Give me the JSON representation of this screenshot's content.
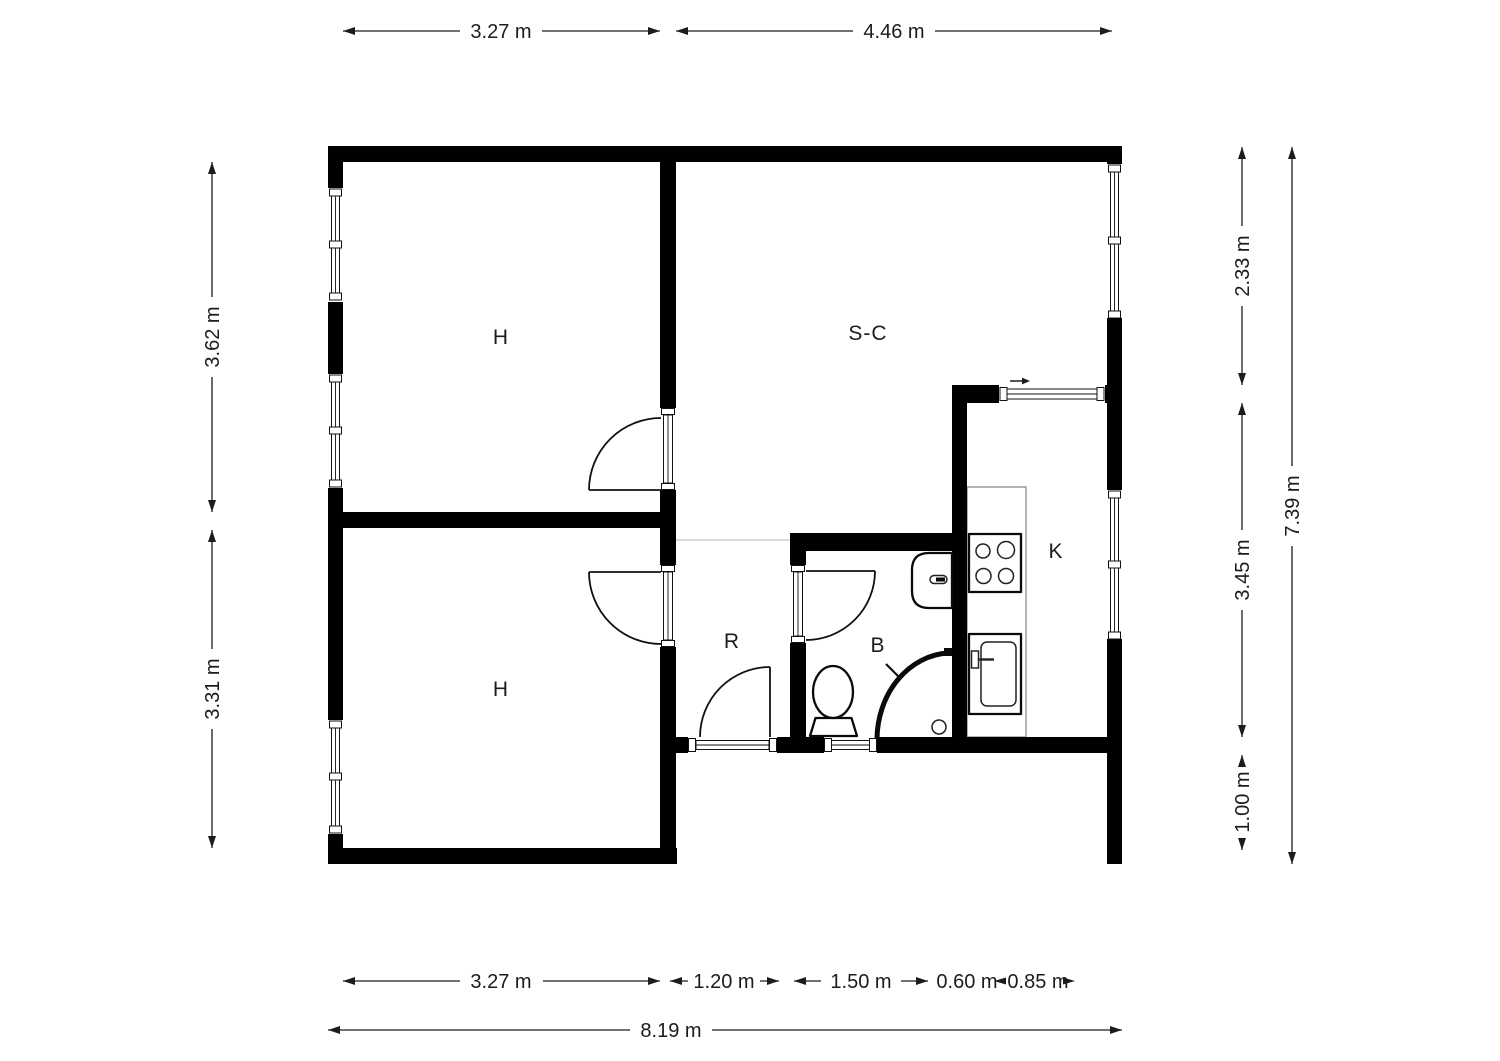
{
  "page": {
    "background_color": "#ffffff"
  },
  "floorplan": {
    "type": "apartment-floor-plan",
    "unit_suffix": "m",
    "room_labels": {
      "bedroom_top": "H",
      "living_room": "S-C",
      "bedroom_bottom": "H",
      "hall": "R",
      "bathroom": "B",
      "kitchen": "K"
    },
    "dimensions": {
      "top": {
        "left_room_width": "3.27 m",
        "right_room_width": "4.46 m"
      },
      "bottom": {
        "bedroom_width": "3.27 m",
        "hall_width": "1.20 m",
        "bathroom_width": "1.50 m",
        "counter_depth": "0.60 m",
        "kitchen_width": "0.85 m",
        "total_width": "8.19 m"
      },
      "left": {
        "top_room_height": "3.62 m",
        "bottom_room_height": "3.31 m"
      },
      "right": {
        "upper_height": "2.33 m",
        "middle_height": "3.45 m",
        "lower_height": "1.00 m",
        "total_height": "7.39 m"
      }
    },
    "colors": {
      "wall": "#000000",
      "floor": "#ffffff",
      "dimension_ink": "#1c1c1c",
      "counter_outline": "#9a9a9a",
      "area_divider": "#d9d9d9"
    },
    "symbols": [
      "window-symbol",
      "door-swing-symbol",
      "toilet-icon",
      "shower-enclosure-icon",
      "bathroom-sink-icon",
      "stove-burners-icon",
      "kitchen-sink-icon",
      "swing-direction-arrow-icon"
    ]
  }
}
